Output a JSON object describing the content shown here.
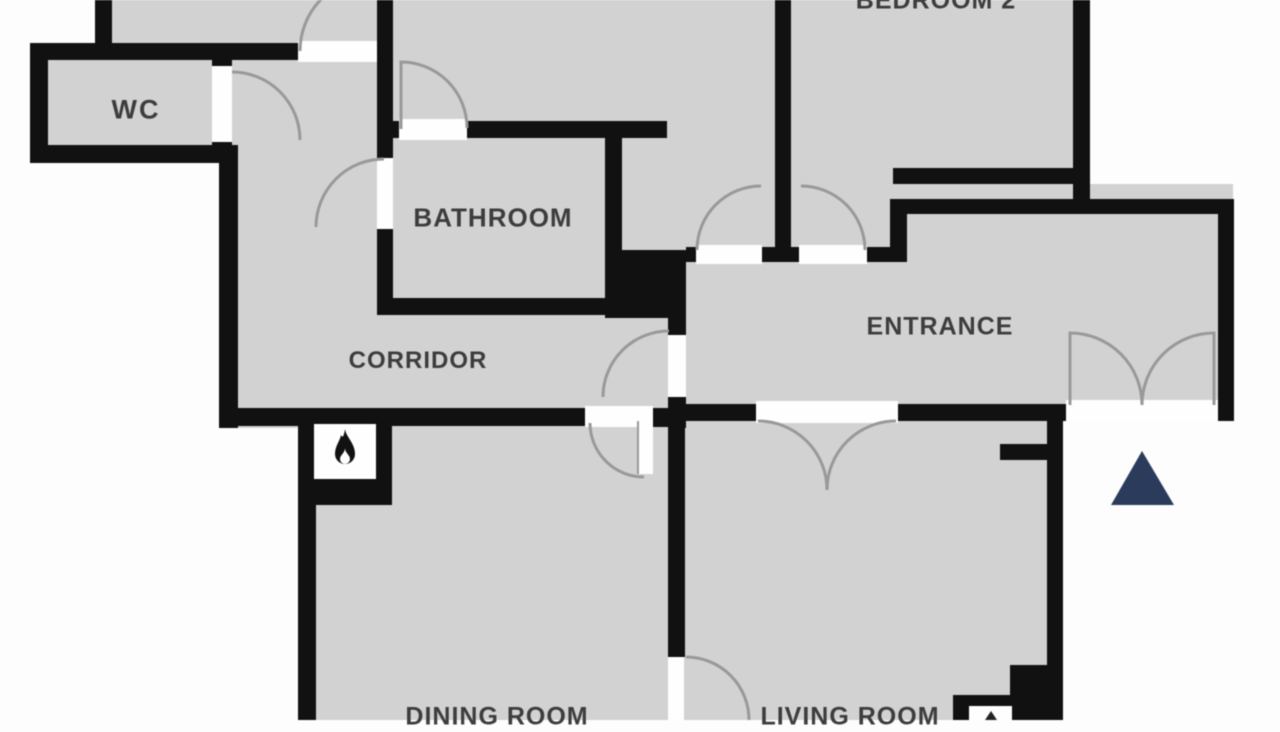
{
  "plan": {
    "rooms": {
      "wc": {
        "label": "WC"
      },
      "bathroom": {
        "label": "BATHROOM"
      },
      "corridor": {
        "label": "CORRIDOR"
      },
      "entrance": {
        "label": "ENTRANCE"
      },
      "bedroom2": {
        "label": "BEDROOM 2"
      },
      "dining_room": {
        "label": "DINING ROOM"
      },
      "living_room": {
        "label": "LIVING ROOM"
      }
    },
    "icons": {
      "fireplace": {
        "name": "flame-icon"
      },
      "north": {
        "name": "north-arrow-triangle"
      },
      "utility": {
        "name": "utility-box-icon"
      }
    },
    "colors": {
      "background": "#fdfdfd",
      "floor": "#d2d2d2",
      "wall": "#111111",
      "door_gap": "#fefefe",
      "door_arc": "#999999",
      "label": "#3d3d3d",
      "north_triangle": "#2b3b5c"
    }
  }
}
